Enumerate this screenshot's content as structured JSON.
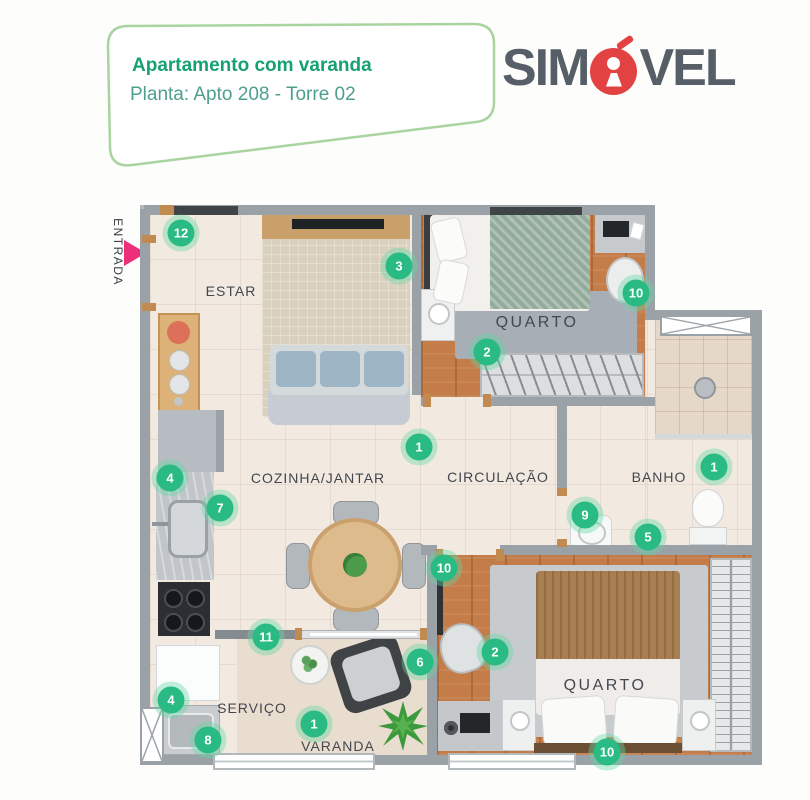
{
  "header": {
    "card": {
      "title": "Apartamento com varanda",
      "subtitle": "Planta: Apto 208 - Torre 02",
      "border_color": "#a9d4a0",
      "title_color": "#17a173",
      "subtitle_color": "#4f9f8d"
    },
    "logo": {
      "text_before": "SIM",
      "text_after": "VEL",
      "keyhole_icon": "keyhole-in-red-circle-for-letter-O",
      "text_color": "#565e67",
      "accent_color": "#e24241"
    }
  },
  "plan": {
    "entrance": {
      "label": "ENTRADA",
      "arrow_color": "#ec2e7b"
    },
    "badge_color": "#2abb84",
    "wall_color": "#9aa1a7",
    "rooms": [
      {
        "id": "estar",
        "label": "ESTAR",
        "x": 91,
        "y": 86
      },
      {
        "id": "quarto1",
        "label": "QUARTO",
        "x": 397,
        "y": 118
      },
      {
        "id": "cozinha",
        "label": "COZINHA/JANTAR",
        "x": 178,
        "y": 273
      },
      {
        "id": "circulacao",
        "label": "CIRCULAÇÃO",
        "x": 358,
        "y": 272
      },
      {
        "id": "banho",
        "label": "BANHO",
        "x": 519,
        "y": 272
      },
      {
        "id": "servico",
        "label": "SERVIÇO",
        "x": 112,
        "y": 503
      },
      {
        "id": "varanda",
        "label": "VARANDA",
        "x": 198,
        "y": 541
      },
      {
        "id": "quarto2",
        "label": "QUARTO",
        "x": 465,
        "y": 481
      }
    ],
    "badges": [
      {
        "n": "12",
        "x": 41,
        "y": 28
      },
      {
        "n": "3",
        "x": 259,
        "y": 61
      },
      {
        "n": "10",
        "x": 496,
        "y": 88
      },
      {
        "n": "2",
        "x": 347,
        "y": 147
      },
      {
        "n": "1",
        "x": 279,
        "y": 242
      },
      {
        "n": "4",
        "x": 30,
        "y": 273
      },
      {
        "n": "7",
        "x": 80,
        "y": 303
      },
      {
        "n": "9",
        "x": 445,
        "y": 310
      },
      {
        "n": "1",
        "x": 574,
        "y": 262
      },
      {
        "n": "5",
        "x": 508,
        "y": 332
      },
      {
        "n": "10",
        "x": 304,
        "y": 363
      },
      {
        "n": "11",
        "x": 126,
        "y": 432
      },
      {
        "n": "6",
        "x": 280,
        "y": 457
      },
      {
        "n": "2",
        "x": 355,
        "y": 447
      },
      {
        "n": "4",
        "x": 31,
        "y": 495
      },
      {
        "n": "8",
        "x": 68,
        "y": 535
      },
      {
        "n": "1",
        "x": 174,
        "y": 519
      },
      {
        "n": "10",
        "x": 467,
        "y": 547
      }
    ]
  }
}
